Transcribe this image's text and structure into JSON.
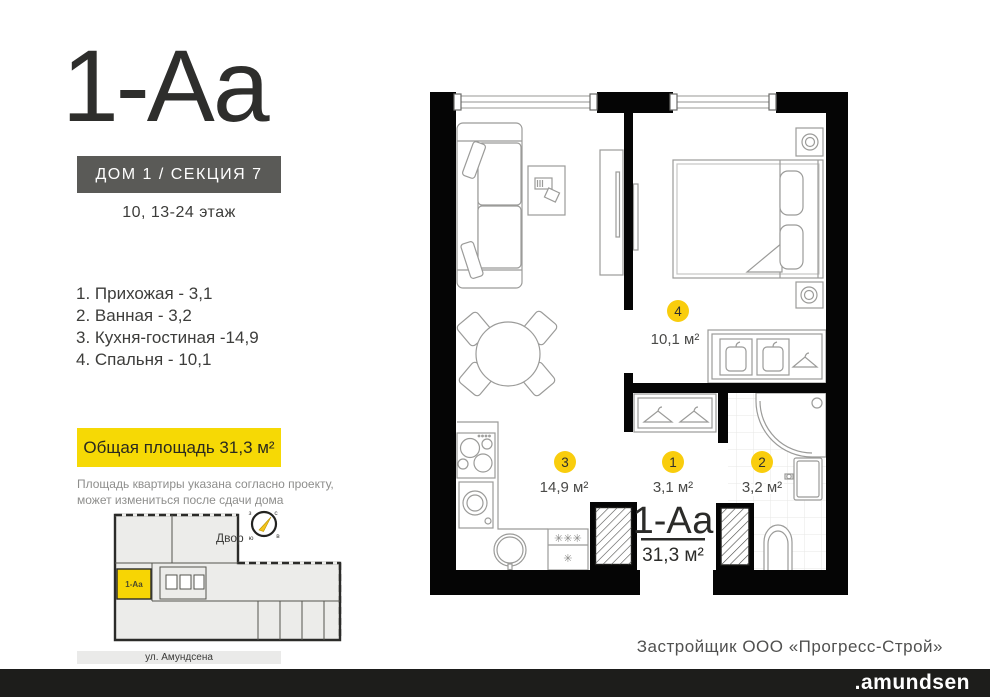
{
  "header": {
    "plan_code": "1-Аа",
    "building": "ДОМ 1 / СЕКЦИЯ 7",
    "floors": "10, 13-24 этаж"
  },
  "legend": [
    "1. Прихожая - 3,1",
    "2. Ванная - 3,2",
    "3. Кухня-гостиная -14,9",
    "4. Спальня - 10,1"
  ],
  "total_area": {
    "label": "Общая площадь 31,3 м²"
  },
  "disclaimer": {
    "line1": "Площадь квартиры указана согласно проекту,",
    "line2": "может измениться после сдачи дома"
  },
  "minimap": {
    "yard": "Двор",
    "street": "ул. Амундсена",
    "unit": "1-Аа",
    "compass": {
      "n": "с",
      "e": "в",
      "s": "ю",
      "w": "з"
    }
  },
  "plan": {
    "unit_label": "1-Аа",
    "unit_area": "31,3 м²",
    "badges": [
      {
        "num": "1",
        "area": "3,1 м²"
      },
      {
        "num": "2",
        "area": "3,2 м²"
      },
      {
        "num": "3",
        "area": "14,9 м²"
      },
      {
        "num": "4",
        "area": "10,1 м²"
      }
    ],
    "fridge_top": "✳✳✳",
    "fridge_bottom": "✳"
  },
  "footer": {
    "developer": "Застройщик ООО «Прогресс-Строй»",
    "brand": ".amundsen"
  },
  "colors": {
    "accent_yellow": "#f6d905",
    "badge_yellow": "#f9cd0d",
    "dark_box": "#5a5a57",
    "footer_bar": "#1d1d1b"
  }
}
